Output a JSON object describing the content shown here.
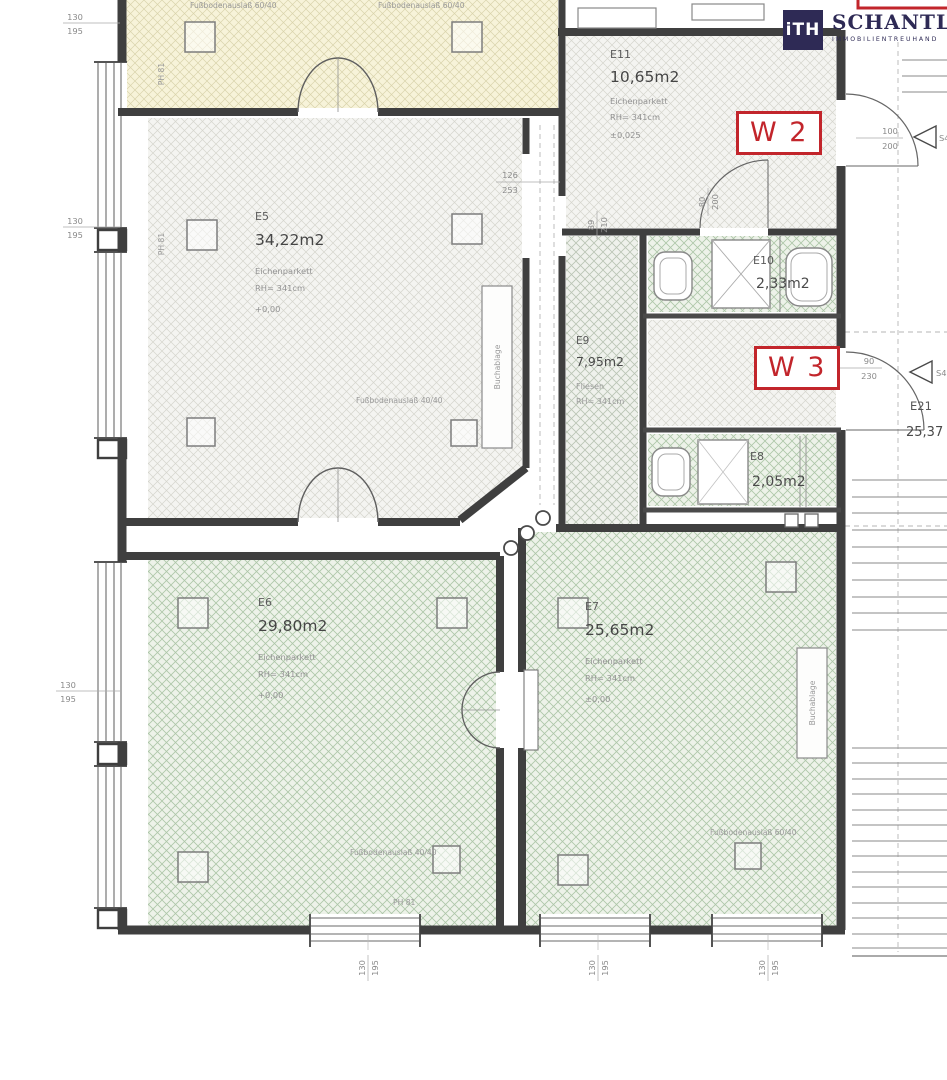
{
  "logo": {
    "mark": "iTH",
    "name": "SCHANTL",
    "subtitle": "IMMOBILIENTREUHAND"
  },
  "badges": {
    "w2": "W 2",
    "w3": "W 3"
  },
  "rooms": {
    "e5": {
      "id": "E5",
      "area": "34,22m2",
      "floor": "Eichenparkett",
      "height": "RH= 341cm",
      "level": "+0,00"
    },
    "e6": {
      "id": "E6",
      "area": "29,80m2",
      "floor": "Eichenparkett",
      "height": "RH= 341cm",
      "level": "+0,00"
    },
    "e7": {
      "id": "E7",
      "area": "25,65m2",
      "floor": "Eichenparkett",
      "height": "RH= 341cm",
      "level": "±0,00"
    },
    "e8": {
      "id": "E8",
      "area": "2,05m2"
    },
    "e9": {
      "id": "E9",
      "area": "7,95m2",
      "floor": "Fliesen",
      "height": "RH= 341cm"
    },
    "e10": {
      "id": "E10",
      "area": "2,33m2"
    },
    "e11": {
      "id": "E11",
      "area": "10,65m2",
      "floor": "Eichenparkett",
      "height": "RH= 341cm",
      "level": "±0,025"
    },
    "e21": {
      "id": "E21",
      "area": "25,37"
    }
  },
  "annotations": {
    "floor_outlet_60": "Fußbodenauslaß 60/40",
    "floor_outlet_40": "Fußbodenauslaß 40/40",
    "wall_label": "PH 81",
    "shelf_label": "Buchablage",
    "door_marker": "S4"
  },
  "dims": {
    "d130": "130",
    "d195": "195",
    "d126": "126",
    "d253": "253",
    "d89": "89",
    "d210": "210",
    "d80": "80",
    "d200": "200",
    "d100": "100",
    "d90": "90",
    "d230": "230"
  },
  "colors": {
    "accent_red": "#c2252b",
    "logo_navy": "#2e2a55",
    "wall": "#3f3f3f",
    "hatch_cream_bg": "#f7f3d9",
    "hatch_gray_bg": "#f4f4f1",
    "hatch_green_bg": "#edf2e9"
  }
}
